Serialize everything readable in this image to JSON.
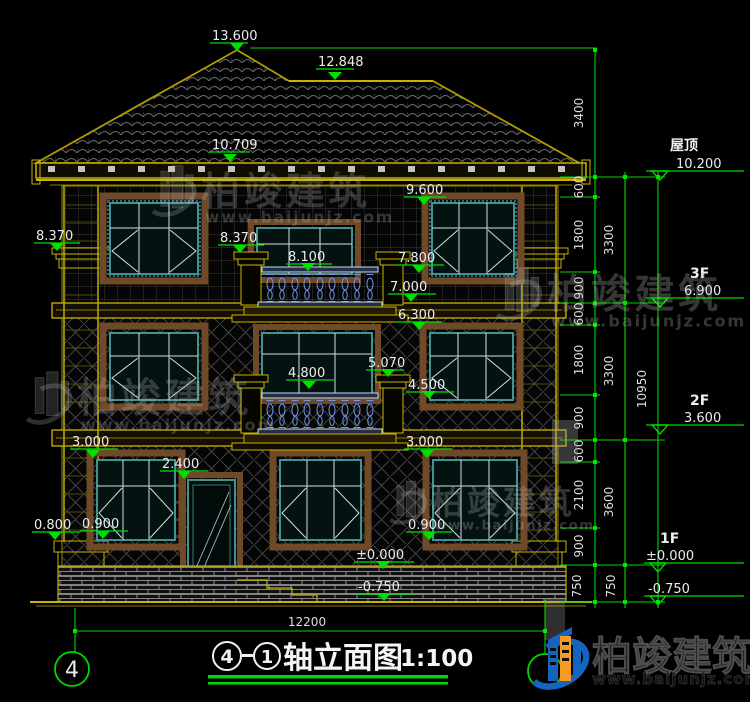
{
  "drawing": {
    "grid_bubble": "4",
    "title": {
      "axis_a": "4",
      "axis_b": "1",
      "name": "轴立面图",
      "scale": "1:100"
    },
    "floor_marks": {
      "peak": "13.600",
      "ridge": "12.848",
      "eave": "10.709",
      "f3_win_top": "9.600",
      "cornice_left": "8.370",
      "cornice_center": "8.370",
      "f3_rail": "8.100",
      "f3_sill": "7.800",
      "f3_slab": "7.000",
      "f2_top": "6.300",
      "f2_post": "5.070",
      "f2_rail": "4.800",
      "f2_sill": "4.500",
      "f1_top_left": "3.000",
      "f1_top_right": "3.000",
      "door_top": "2.400",
      "f1_sill_left": "0.900",
      "f1_sill_right": "0.900",
      "base_left": "0.800",
      "zero": "±0.000",
      "minus": "-0.750"
    },
    "right_marks": {
      "roof_name": "屋顶",
      "roof_val": "10.200",
      "f3_name": "3F",
      "f3_val": "6.900",
      "f2_name": "2F",
      "f2_val": "3.600",
      "f1_name": "1F",
      "f1_val": "±0.000",
      "ground_val": "-0.750"
    },
    "chain": {
      "roof": "3400",
      "s1": "600",
      "s2": "1800",
      "s3": "900",
      "s4": "600",
      "s5": "1800",
      "s6": "900",
      "s7": "600",
      "s8": "2100",
      "s9": "900",
      "s10": "750",
      "m1": "3300",
      "m2": "3300",
      "m3": "3600",
      "m4": "750",
      "total": "10950",
      "width": "12200"
    }
  },
  "watermark": {
    "brand": "柏竣建筑",
    "site": "www.baijunjz.com"
  },
  "colors": {
    "cad_green": "#00d800",
    "cad_yellow": "#c8b400",
    "window_teal": "#3f9490",
    "baluster_blue": "#6f97e8",
    "logo_blue": "#1565c0",
    "logo_orange": "#f59a23"
  }
}
